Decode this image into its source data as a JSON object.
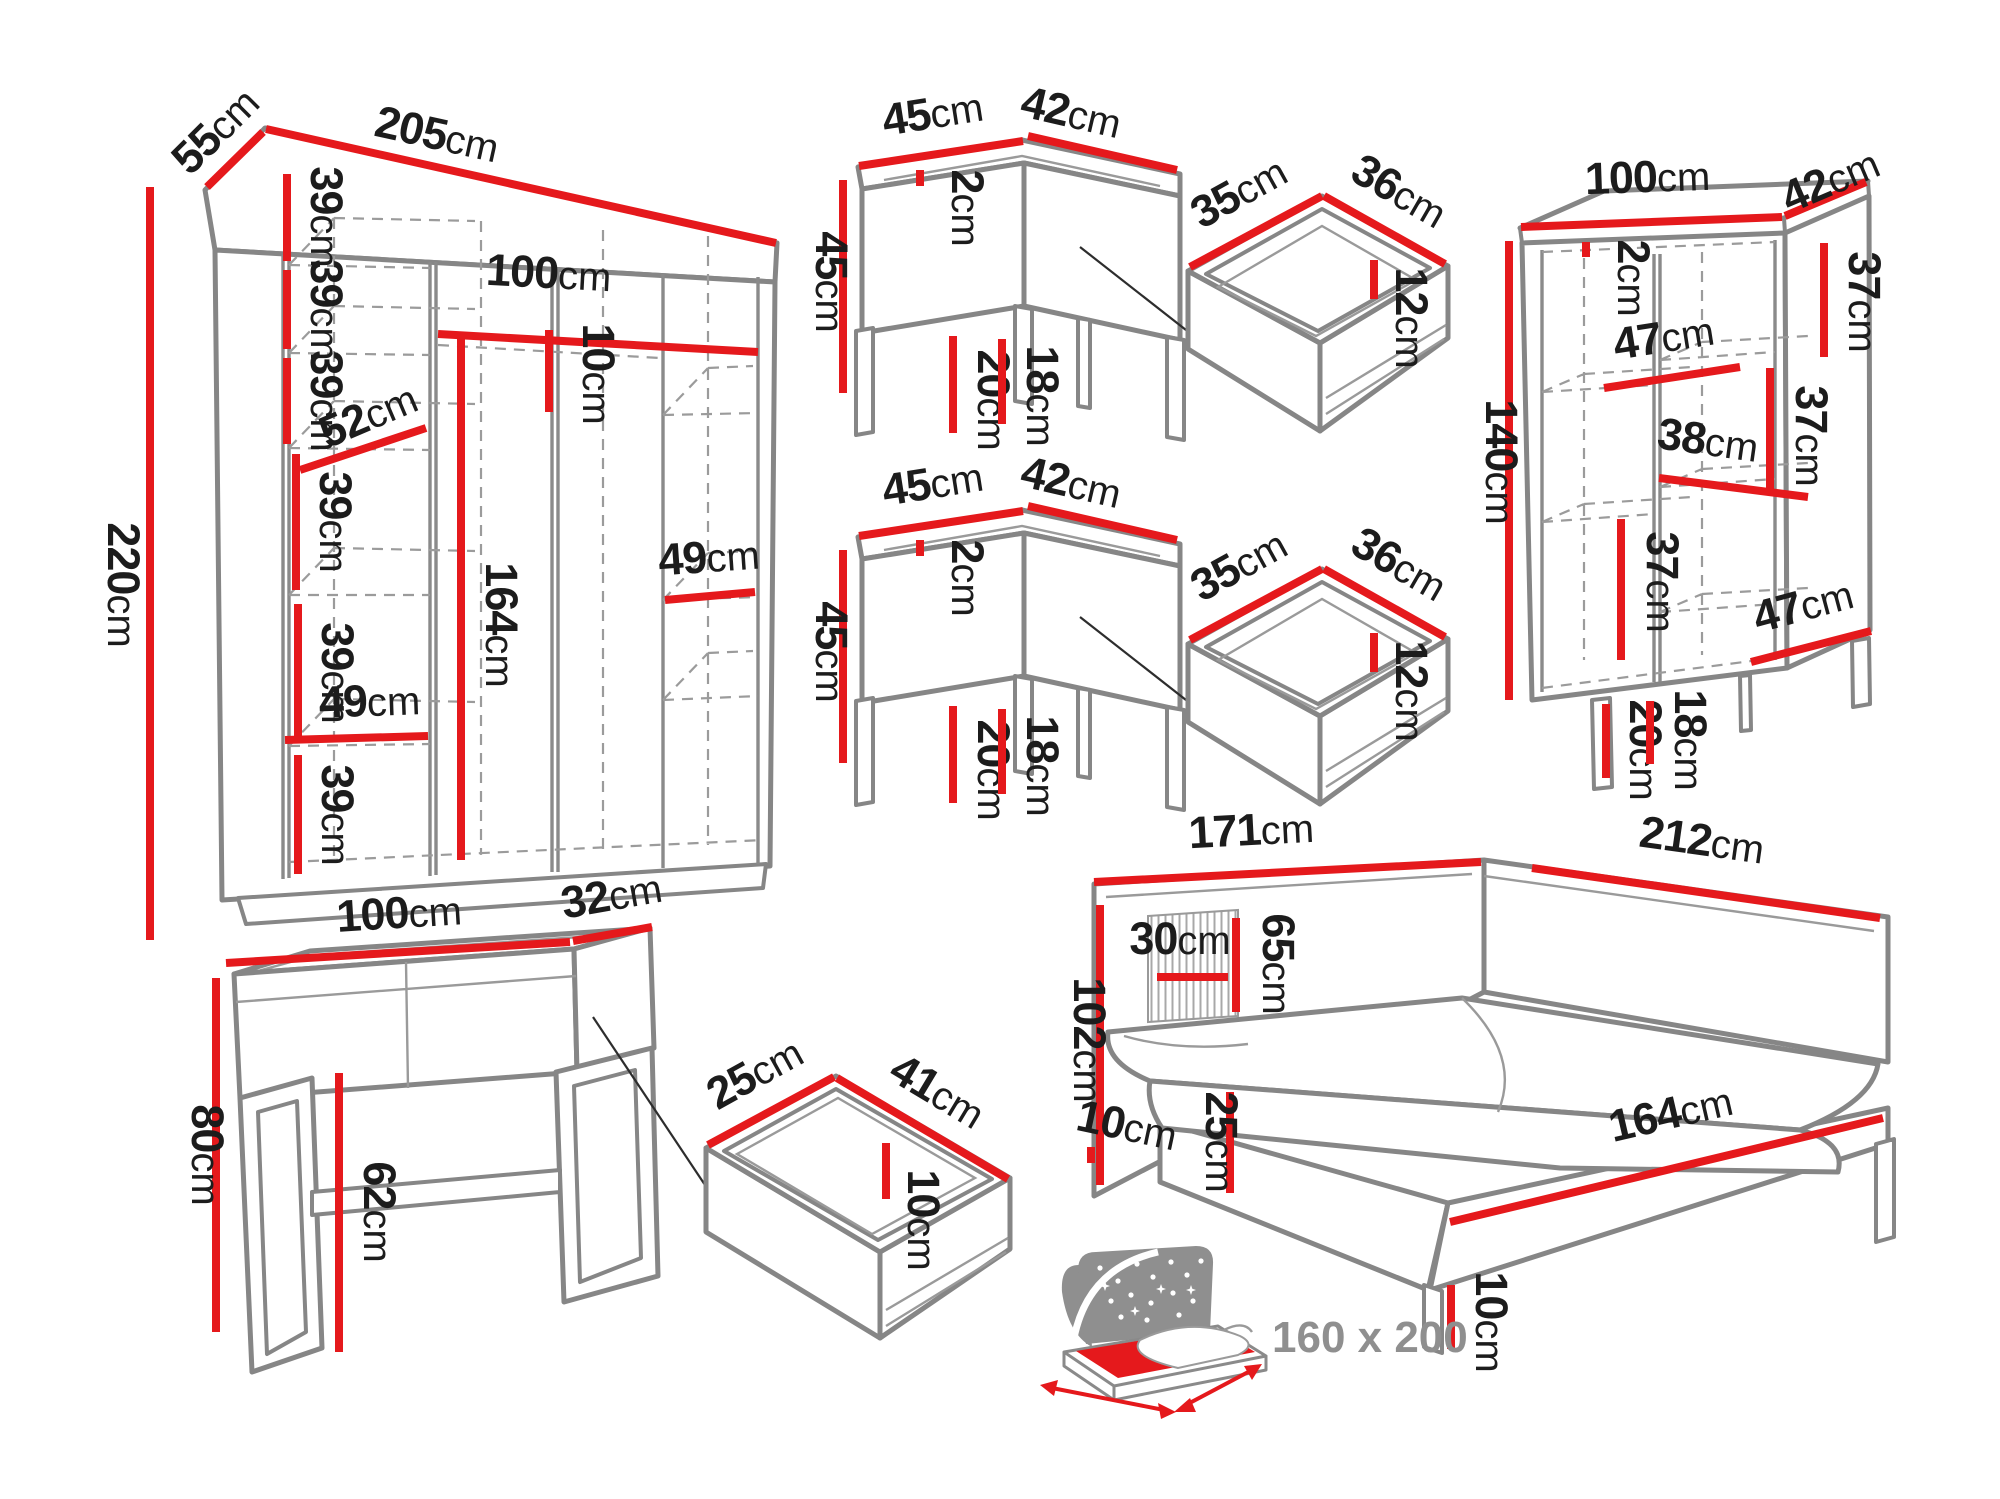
{
  "colors": {
    "dimension_red": "#e5191c",
    "outline_gray": "#868686",
    "label_black": "#1c1c1c",
    "icon_gray": "#8f8f8f"
  },
  "labels": {
    "wardrobe": {
      "depth": {
        "v": "55",
        "u": "cm"
      },
      "width": {
        "v": "205",
        "u": "cm"
      },
      "height": {
        "v": "220",
        "u": "cm"
      },
      "shelf_gap_1": {
        "v": "39",
        "u": "cm"
      },
      "shelf_gap_2": {
        "v": "39",
        "u": "cm"
      },
      "shelf_gap_3": {
        "v": "39",
        "u": "cm"
      },
      "shelf_gap_4": {
        "v": "39",
        "u": "cm"
      },
      "shelf_gap_5": {
        "v": "39",
        "u": "cm"
      },
      "shelf_gap_6": {
        "v": "39",
        "u": "cm"
      },
      "shelf_diag": {
        "v": "52",
        "u": "cm"
      },
      "rod_width": {
        "v": "100",
        "u": "cm"
      },
      "rod_drop": {
        "v": "10",
        "u": "cm"
      },
      "hang_height": {
        "v": "164",
        "u": "cm"
      },
      "shelf_width_left": {
        "v": "49",
        "u": "cm"
      },
      "shelf_width_right": {
        "v": "49",
        "u": "cm"
      }
    },
    "nightstand_top": {
      "width": {
        "v": "45",
        "u": "cm"
      },
      "depth": {
        "v": "42",
        "u": "cm"
      },
      "height": {
        "v": "45",
        "u": "cm"
      },
      "top_thickness": {
        "v": "2",
        "u": "cm"
      },
      "leg_height": {
        "v": "20",
        "u": "cm"
      },
      "clearance": {
        "v": "18",
        "u": "cm"
      }
    },
    "drawer_top": {
      "width": {
        "v": "35",
        "u": "cm"
      },
      "depth": {
        "v": "36",
        "u": "cm"
      },
      "height": {
        "v": "12",
        "u": "cm"
      }
    },
    "nightstand_bottom": {
      "width": {
        "v": "45",
        "u": "cm"
      },
      "depth": {
        "v": "42",
        "u": "cm"
      },
      "height": {
        "v": "45",
        "u": "cm"
      },
      "top_thickness": {
        "v": "2",
        "u": "cm"
      },
      "leg_height": {
        "v": "20",
        "u": "cm"
      },
      "clearance": {
        "v": "18",
        "u": "cm"
      }
    },
    "drawer_bottom": {
      "width": {
        "v": "35",
        "u": "cm"
      },
      "depth": {
        "v": "36",
        "u": "cm"
      },
      "height": {
        "v": "12",
        "u": "cm"
      }
    },
    "cabinet": {
      "width": {
        "v": "100",
        "u": "cm"
      },
      "depth": {
        "v": "42",
        "u": "cm"
      },
      "height": {
        "v": "140",
        "u": "cm"
      },
      "top_thickness": {
        "v": "2",
        "u": "cm"
      },
      "section_right_top": {
        "v": "37",
        "u": "cm"
      },
      "shelf_left_top": {
        "v": "47",
        "u": "cm"
      },
      "section_right_mid": {
        "v": "37",
        "u": "cm"
      },
      "shelf_mid": {
        "v": "38",
        "u": "cm"
      },
      "section_left_bottom": {
        "v": "37",
        "u": "cm"
      },
      "shelf_right_bottom": {
        "v": "47",
        "u": "cm"
      },
      "leg_height": {
        "v": "20",
        "u": "cm"
      },
      "clearance": {
        "v": "18",
        "u": "cm"
      }
    },
    "console": {
      "width": {
        "v": "100",
        "u": "cm"
      },
      "depth": {
        "v": "32",
        "u": "cm"
      },
      "height": {
        "v": "80",
        "u": "cm"
      },
      "clearance": {
        "v": "62",
        "u": "cm"
      }
    },
    "console_drawer": {
      "width": {
        "v": "25",
        "u": "cm"
      },
      "depth": {
        "v": "41",
        "u": "cm"
      },
      "height": {
        "v": "10",
        "u": "cm"
      }
    },
    "bed": {
      "headboard_width": {
        "v": "171",
        "u": "cm"
      },
      "side_length": {
        "v": "212",
        "u": "cm"
      },
      "headboard_height": {
        "v": "102",
        "u": "cm"
      },
      "panel_width": {
        "v": "30",
        "u": "cm"
      },
      "panel_height": {
        "v": "65",
        "u": "cm"
      },
      "panel_offset": {
        "v": "10",
        "u": "cm"
      },
      "frame_height": {
        "v": "25",
        "u": "cm"
      },
      "frame_length": {
        "v": "164",
        "u": "cm"
      },
      "leg_height": {
        "v": "10",
        "u": "cm"
      }
    },
    "mattress": {
      "size": {
        "v": "160 x 200",
        "u": ""
      }
    }
  }
}
